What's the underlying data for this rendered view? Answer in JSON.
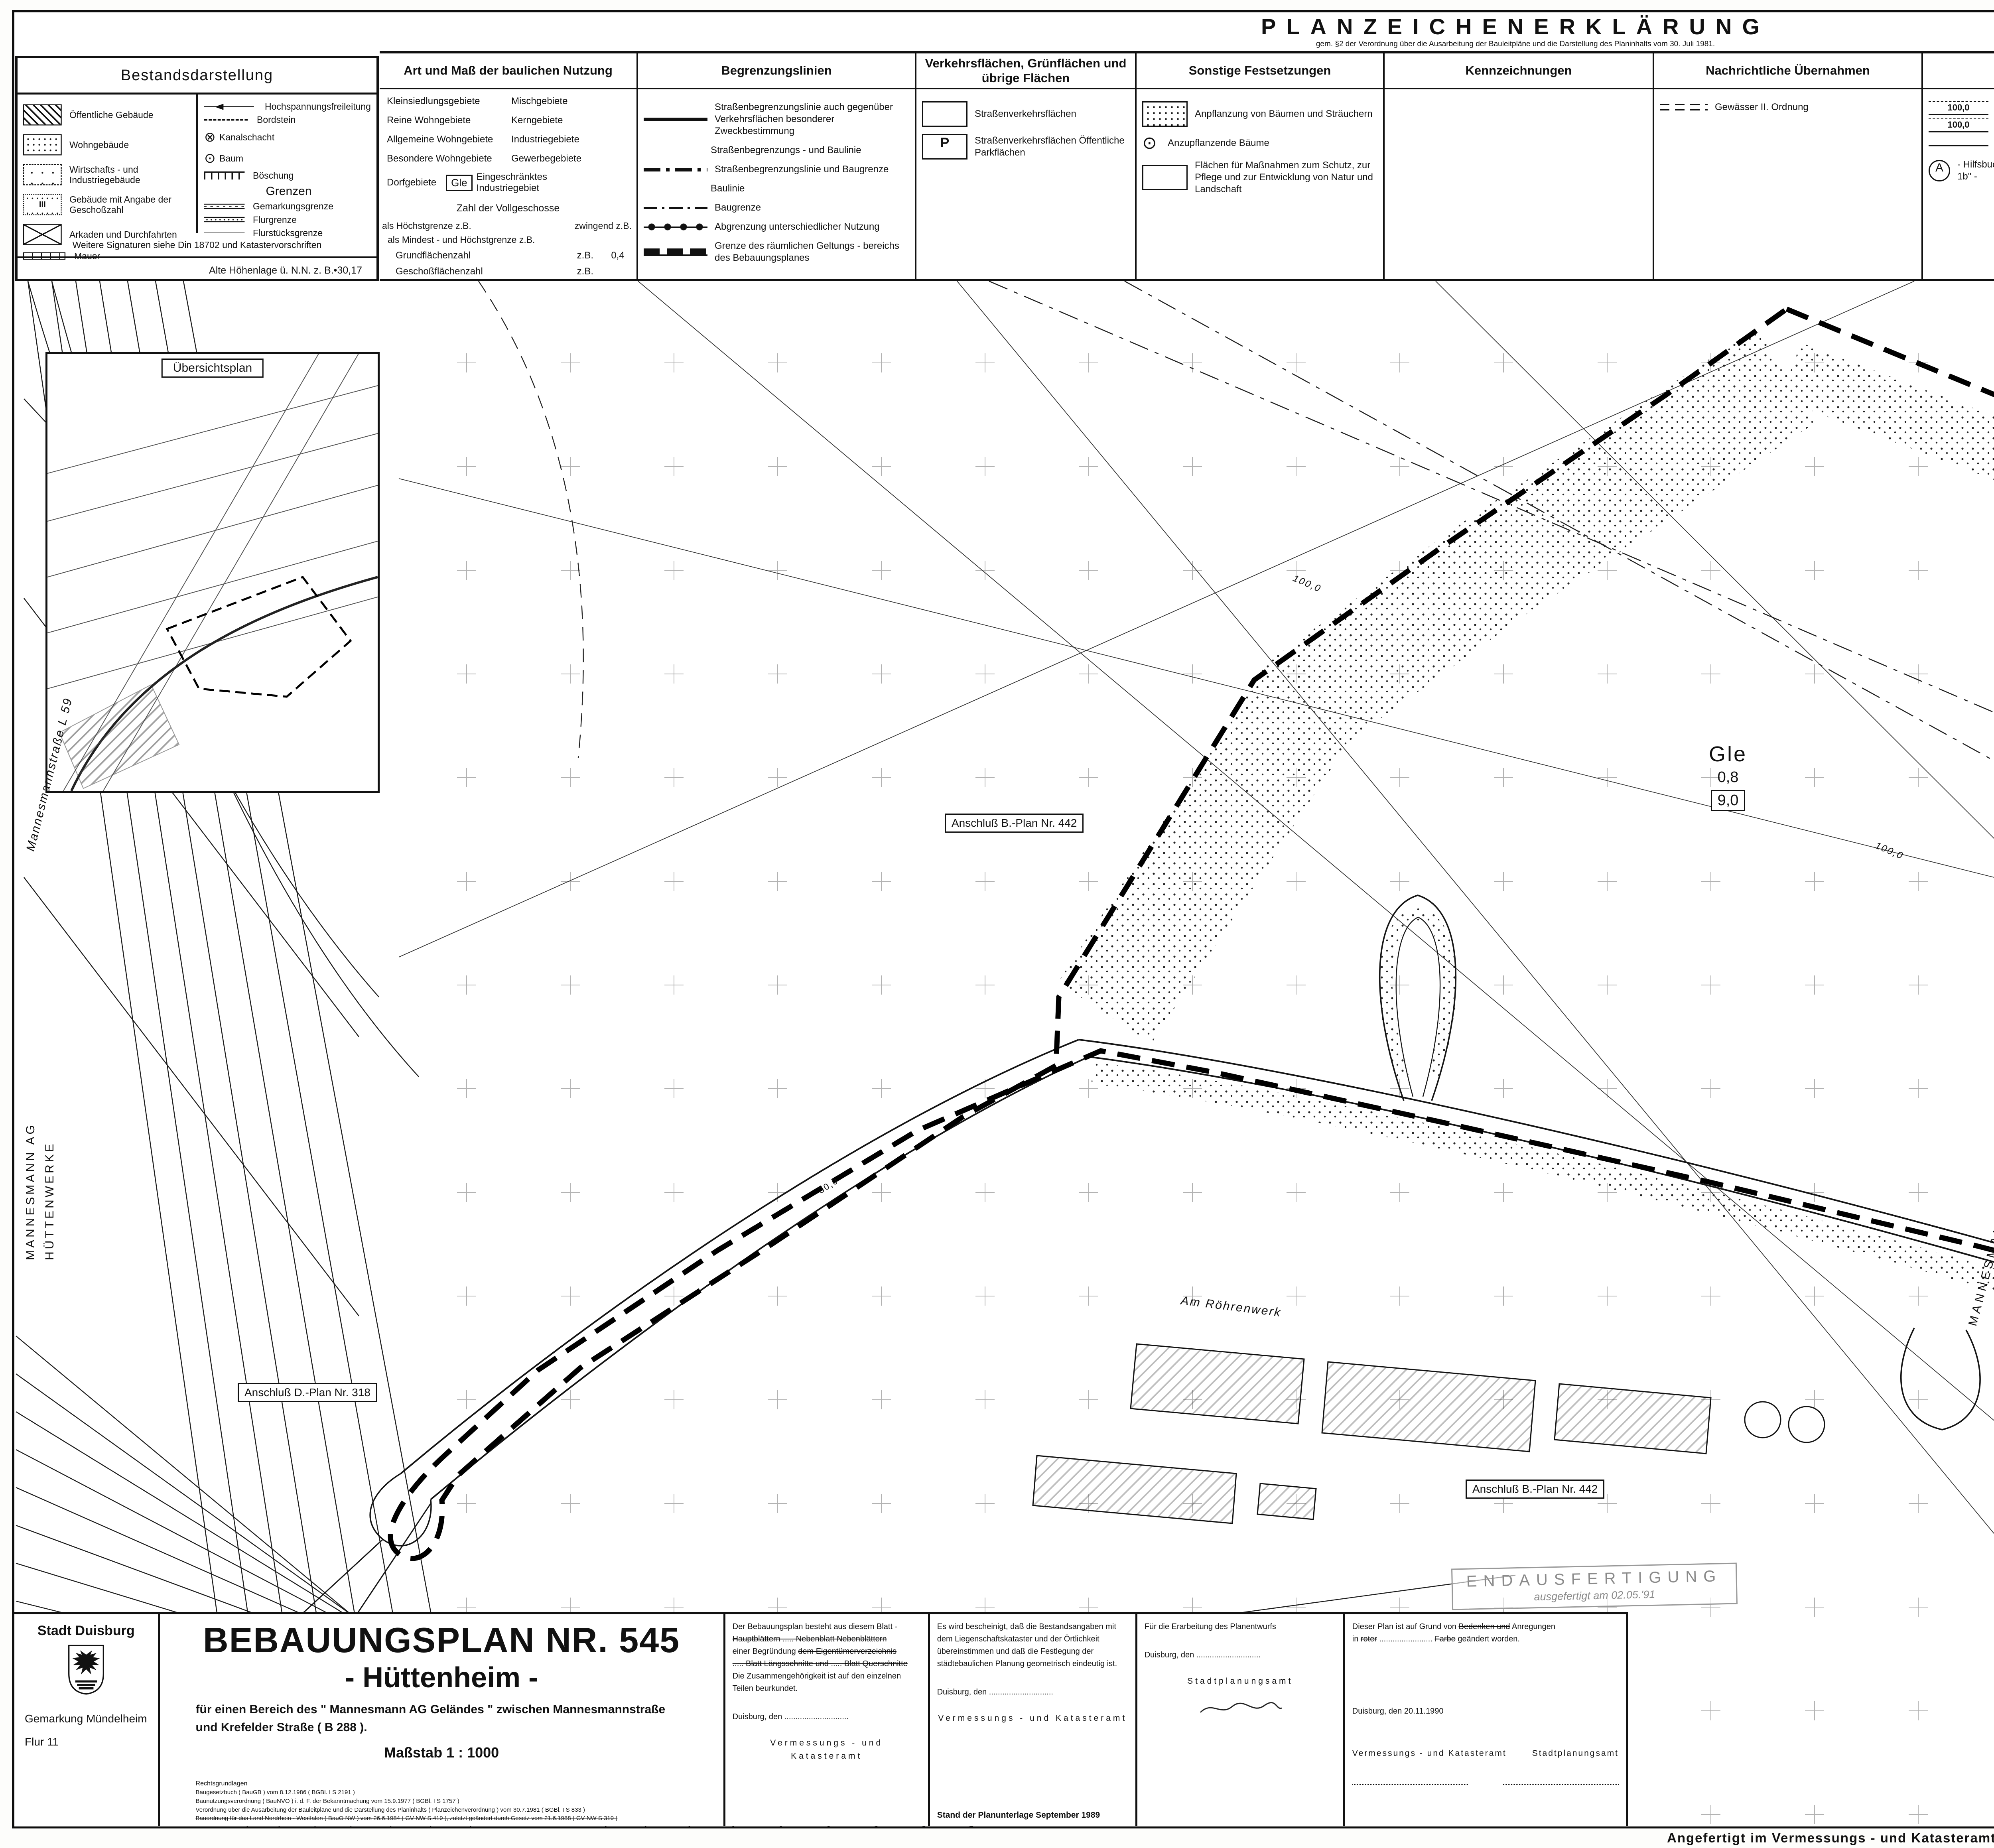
{
  "bestand": {
    "title": "Bestandsdarstellung",
    "left_items": [
      {
        "icon": "hatch-box",
        "label": "Öffentliche Gebäude"
      },
      {
        "icon": "dots-box",
        "label": "Wohngebäude"
      },
      {
        "icon": "sparse-dots-box",
        "label": "Wirtschafts - und Industriegebäude"
      },
      {
        "icon": "dots-box-iii",
        "label": "Gebäude mit Angabe der Geschoßzahl"
      },
      {
        "icon": "cross-box",
        "label": "Arkaden und Durchfahrten"
      },
      {
        "icon": "wall-symbol",
        "label": "Mauer"
      }
    ],
    "right_items": [
      {
        "icon": "arrow-line",
        "label": "Hochspannungsfreileitung"
      },
      {
        "icon": "dashed-line",
        "label": "Bordstein"
      },
      {
        "icon": "circle-cross",
        "label": "Kanalschacht"
      },
      {
        "icon": "circle-dot",
        "label": "Baum"
      },
      {
        "icon": "slope-symbol",
        "label": "Böschung"
      }
    ],
    "grenzen_title": "Grenzen",
    "grenzen_items": [
      {
        "icon": "double-line-dashdot",
        "label": "Gemarkungsgrenze"
      },
      {
        "icon": "double-line-dots",
        "label": "Flurgrenze"
      },
      {
        "icon": "single-line",
        "label": "Flurstücksgrenze"
      }
    ],
    "footer": "Weitere Signaturen siehe Din 18702 und Katastervorschriften",
    "altitude_note": "Alte Höhenlage ü. N.N. z. B.•30,17"
  },
  "plz": {
    "title": "PLANZEICHENERKLÄRUNG",
    "subtitle": "gem. §2 der Verordnung über die Ausarbeitung der Bauleitpläne und die Darstellung des Planinhalts vom 30. Juli 1981.",
    "col1": {
      "header": "Art und Maß der baulichen Nutzung",
      "pairs": [
        [
          "Kleinsiedlungsgebiete",
          "Mischgebiete"
        ],
        [
          "Reine Wohngebiete",
          "Kerngebiete"
        ],
        [
          "Allgemeine Wohngebiete",
          "Industriegebiete"
        ],
        [
          "Besondere Wohngebiete",
          "Gewerbegebiete"
        ]
      ],
      "dorf": "Dorfgebiete",
      "gle_badge": "Gle",
      "gle_label": "Eingeschränktes Industriegebiet",
      "vollgeschosse": "Zahl der Vollgeschosse",
      "hoechst": "als Höchstgrenze   z.B.",
      "zwingend": "zwingend   z.B.",
      "mindest": "als Mindest - und Höchstgrenze   z.B.",
      "grz_label": "Grundflächenzahl",
      "grz_zb": "z.B.",
      "grz_val": "0,4",
      "gfz_label": "Geschoßflächenzahl",
      "gfz_zb": "z.B.",
      "bmz_label": "Baumassenzahl",
      "bmz_zb": "z.B.",
      "bmz_val": "9,0"
    },
    "col2": {
      "header": "Begrenzungslinien",
      "items": [
        {
          "icon": "thick-line",
          "label": "Straßenbegrenzungslinie auch gegenüber Verkehrsflächen besonderer Zweckbestimmung"
        },
        {
          "icon": "none",
          "label": "Straßenbegrenzungs - und Baulinie"
        },
        {
          "icon": "dashdot-thick",
          "label": "Straßenbegrenzungslinie und Baugrenze"
        },
        {
          "icon": "none",
          "label": "Baulinie"
        },
        {
          "icon": "dashdot-thin",
          "label": "Baugrenze"
        },
        {
          "icon": "dot-knots-line",
          "label": "Abgrenzung unterschiedlicher Nutzung"
        },
        {
          "icon": "block-dash-line",
          "label": "Grenze des räumlichen Geltungs - bereichs des Bebauungsplanes"
        }
      ]
    },
    "col3": {
      "header": "Verkehrsflächen, Grünflächen und übrige Flächen",
      "items": [
        {
          "icon": "empty-box",
          "label": "Straßenverkehrsflächen"
        },
        {
          "icon": "p-box",
          "label": "Straßenverkehrsflächen Öffentliche Parkflächen"
        }
      ]
    },
    "col4": {
      "header": "Sonstige Festsetzungen",
      "items": [
        {
          "icon": "stipple-box",
          "label": "Anpflanzung von Bäumen und Sträuchern"
        },
        {
          "icon": "circle-dot",
          "label": "Anzupflanzende Bäume"
        },
        {
          "icon": "empty-box",
          "label": "Flächen für Maßnahmen zum Schutz, zur Pflege und zur Entwicklung von Natur und Landschaft"
        }
      ]
    },
    "col5": {
      "header": "Kennzeichnungen"
    },
    "col6": {
      "header": "Nachrichtliche Übernahmen",
      "items": [
        {
          "icon": "dash-double",
          "label": "Gewässer II. Ordnung"
        }
      ]
    },
    "col7": {
      "header": "Vermerke",
      "zone_value": "100,0",
      "items": [
        {
          "icon": "zone-100",
          "label": "Zone der Richtfunkverbindung - Siehe \"Textliche Festsetzungen Ziffer III.\""
        },
        {
          "icon": "thin-line",
          "label": "Neuer Bordstein"
        },
        {
          "icon": "circle-a",
          "label": "- Hilfsbuchstabe - Siehe \"Textliche Festsetzungen Ziffer I. 1b\" -"
        }
      ]
    },
    "hinweis_title": "Hinweis:",
    "hinweis_text": "Die bei Bodenbewegungen auftretenden archäologischen Bodenfunde und -befunde sind gemäß Gesetz zum Schutz und zur Pflege der Denkmäler im Land Nordrhein - Westfalen ( Denkmalschutzgesetz - DSchG ) vom 11.03.1980 unmittelbar dem Rheinischen Landesmuseum Bonn, Rheinisches Amt für Bodendenkmalpflege zu melden."
  },
  "rc": {
    "blocks": [
      {
        "body": "Der Rat der Stadt hat am 12.12.1988 nach § 2 [ 1 ] Baugesetzbuch die Aufstellung dieses Bebauungsplan - Entwurfes beschlossen.",
        "place_date": "Duisburg, den 13.10.1989",
        "officer": "Der Oberstadtdirektor",
        "deputy": "In Vertretung",
        "seal": "(Siegel)",
        "signature": "gez. Giersch",
        "rank": "Beigeordneter"
      },
      {
        "body": "Der Aufstellungsbeschluß wurde am 30.12.1988 gemäß § 2 [ 1 ] Baugesetzbuch ortsüblich bekannt gemacht.",
        "place_date": "Duisburg, den 13.10.1989",
        "officer": "Der Oberstadtdirektor",
        "deputy": "In Vertretung",
        "seal": "(Siegel)",
        "signature": "gez. Giersch",
        "rank": "Beigeordneter"
      },
      {
        "body": "Der Rat der Stadt hat am 18.09.1989 nach § 3 [1] Baugesetzbuch beschlossen, eine Bürgerbeteiligung nicht durchzuführen.",
        "place_date": "Duisburg, den 13.10.1989",
        "officer": "Der Oberstadtdirektor",
        "deputy": "In Vertretung",
        "seal": "(Siegel)",
        "signature": "gez. Giersch",
        "rank": "Beigeordneter"
      },
      {
        "body": "Ein Beschluß des Rates der Stadt nach § 3 [1] Baugesetzbuch wurde nicht gefaßt.",
        "place_date": "Duisburg, den",
        "officer": "Der Oberstadtdirektor",
        "deputy": "In Vertretung",
        "seal": "(Siegel)",
        "signature": "",
        "rank": "Beigeordneter"
      },
      {
        "body": "Der Rat der Stadt hat am 18.09.1989 nach § 3 [2] Baugesetzbuch diesen Bebauungsplan - Entwurf und seine öffentliche Auslegung beschlossen.",
        "place_date": "Duisburg, den 13.10.1989",
        "officer": "Der Oberstadtdirektor",
        "deputy": "In Vertretung",
        "seal": "(Siegel)",
        "signature": "gez. Giersch",
        "rank": "Beigeordneter"
      },
      {
        "body": "Dieser Bebauungsplan - Entwurf, die Begründung und die aufzuhebenden Bebauungspläne [ siehe Aufhebungsvermerk ] haben nach § 3 [2], § 2 [4] Baugesetzbuch auf die Dauer eines Monats in der Zeit vom 23.10.1989 bis 27.11.1989 einschließlich zu jedermanns Einsicht öffentlich ausgelegen.",
        "place_date": "Duisburg, den 21.12.1990",
        "officer": "Der Oberstadtdirektor",
        "deputy": "In Vertretung",
        "seal": "(Siegel)",
        "signature": "gez. Giersch",
        "rank": "Beigeordneter"
      },
      {
        "body": "Der Rat der Stadt hat am 17.12.1990 nach § 10 Baugesetzbuch diesen Bebauungsplan einschließlich der Änderungen in roter Farbe sowie die Aufhebungen der Festsetzungen, die diesem Bebauungsplan entgegenstehen [ siehe Aufhebungsvermerk ] als Satzung beschlossen.",
        "place_date": "Duisburg, den 21.12.1990",
        "officer": "Der Oberstadtdirektor",
        "deputy": "In Vertretung",
        "seal": "(Siegel)",
        "signature": "gez. Giersch",
        "rank": "Beigeordneter"
      },
      {
        "body": "Dieser Bebauungsplan hat mir im Anzeigeverfahren gem. § 11 Abs. 3 Baugesetzbuch vorgelegen.\nMit Verfügung vom 03.04.1991  Az.: 35.2 - 12.02 ( Dui 545 )\nhabe ich keine Rechtsverstöße geltend gemacht.",
        "place_date": "Düsseldorf, den 03.04.1991",
        "officer": "Der Regierungspräsident",
        "deputy": "Im Auftrage",
        "seal": "(Siegel)",
        "signature": "gez. Schwetlick",
        "rank": ""
      },
      {
        "body": "Die Durchführung des Anzeigeverfahrens gemäß § 11 Abs. 3 Baugesetzbuch beim Regierungspräsidenten Düsseldorf mit der Verfügung vom 03.04.1991  Az: 35.2.- 12.02 (Dui 545), daß keine Rechtsverstöße geltend gemacht wurden, ist am 02.05.1991 gemäß § 12 Baugesetzbuch mit dem Hinweis, daß dieser Bebauungsplan als Satzung mit Begründung am Tage der Veröffentlichung der Bekanntmachung ab im Zimmer 415 des Stadthauses an den Werktagen, montags bis freitags, in der Zeit von 7.30 Uhr bis 16.00 Uhr, zu jedermanns Einsicht öffentlich ausliegt, orts - üblich bekanntgemacht worden.\nMit dieser Bekanntmachung tritt der Bebauungsplan in Kraft.\nAuf die §§ 44 Abs. 3, 4 und 215 Abs. 1 Baugesetzbuch sowie auf § 4 Abs. 6 der Gemeindeordnung NW wurde bei der Bekanntmachung hingewiesen.",
        "place_date": "Duisburg, den 03.05.1991",
        "officer": "Der Oberstadtdirektor",
        "deputy": "In Vertretung",
        "seal": "(Siegel)",
        "signature": "gez. Giersch",
        "rank": "Beigeordneter"
      }
    ]
  },
  "textfest": {
    "title": "Textliche Festsetzungen",
    "paragraphs": [
      "I. Art und Maß der Nutzung auf den überbaubaren und nicht überbaubaren Grund-\n   stücksflächen",
      "  1. Gemäß § 1 Abs. 9 in Verbindung mit § 1 Abs. 5 der Baunutzungsverordnung\n     (BauNVO) sind",
      "     a) im gesamten GIe-Gebiet die in der \"Abstandsliste\" zum Abstandserlaß\n        (RdErl. d. Ministers für Arbeit, Gesundheit und Soziales - III 86 -\n        8804.25 - vom 09.07.1982) aufgeführten Betriebsarten der Abstands-\n        klassen I, II, III und IV sowie Anlagen mit ähnlichem Emissionsgrad\n        nicht zulässig und",
      "     b) zusätzlich in dem mit Ⓐ bezeichneten südöstlichen Bereich die in der\n        genannten \"Abstandsliste\" aufgeführten Betriebsarten der Abstands-\n        klasse V sowie Anlagen mit ähnlichem Emissionsgrad nicht zulässig.",
      "II. Festsetzungen gemäß § 9 (1) 25 a  Baugesetzbuch (BauGB)",
      "  1. In den durch die Geländeanschüttung entstehenden Böschungsbereichen sind\n     folgende heimische Laubgehölze anzupflanzen:",
      "     Spitzahorn, Bergahorn, Stieleiche, Winterlinde, Kornelkirsche, Hart-\n     riegel, Hasel, Eingriffeliger Weißdorn, Pfaffenhütchen, Sanddorn,\n     Kreuzdorn, Wolliger Schneeball, Feldahorn, Hainbuche, Vogelbeere, Ge-\n     meine Heckenkirsche, Vielblütige Wildrose, Brombeere.",
      "  2. Die im Bebauungsplan festgesetzten Flächen für Anpflanzung von Bäumen\n     und Sträuchern sind mit den unter 1. aufgeführten Pflanzen zu begrünen.",
      "  3. Ebenerdige Stellplatzflächen sind derart zu begrünen, daß für jeweils 5\n     Stellplätze ein großkroniger Laubbaum gepflanzt wird.",
      "  4. Fassadenflächen, die auf einer Länge von 4 m keine Fenster, Tor- oder\n     Türöffnungen enthalten, sind pro angefangener 4 m mit einer der folgenden\n     Kletterpflanzen zu begrünen:",
      "     Waldrebe, Efeu, Wilder Wein, Knöterich,  Je-länger - je lieber.",
      "III. Fesetzungen gemäß § 9 (2) BauGB",
      "     Innerhalb der im Plan gekennzeichneten 200 m breiten Zone - Richtfunk-\n     strecke der Deutschen Bundespost - darf die Gebäudehöhe (einschließ-\n     lich Aufbauten, Antennen usw.) 100 m über NN nicht überschreiten."
    ]
  },
  "aufhebung": {
    "title": "Aufhebungsvermerk",
    "paragraphs": [
      "Mit Inkrafttreten dieses Bebauungsplanes sind alle nach früheren baurecht-\nlichen Vorschriften und städtebaulichen Plänen im Bereich dieses Bebauungs-\nplanes getroffenen Festsetzungen aufgehoben.",
      "Hierbei handelt es sich um die",
      "a) teilweise Aufhebung des Bebauungsplanes Nr. 442, Gebiet zwischen Mannes-\n   mannstraße, Ungelsheimer Graben, Krefelder Straße und Goldackergraben,\n   rechtsverbindlich seit dem 10.11.1964",
      "   und die",
      "b) teilweise Aufhebung des Durchführungsplanes Nr. 318, Blatt 3 und 5, Ver-\n   legung der Huckinger Straße (jetzt Mannesmannstraße) zwischen Hüttenheim\n   und Ehinger Berg, förmlich festgestellt am 20.04.1959."
    ],
    "oertliche": "Örtliche Bauvorschriften entfallen!"
  },
  "map": {
    "uebersichtsplan": "Übersichtsplan",
    "gle": "Gle",
    "gle_value": "0,8",
    "gle_box": "9,0",
    "hilfsbuchstabe": "A",
    "natur_box": "Fläche für Maßnahmen\nzum Schutz, zur Pflege\nund zur Entwicklung\nvon Natur und Land-\nschaft\n-Naturbelassene Fläche-",
    "anschluss_442": "Anschluß B.-Plan Nr. 442",
    "anschluss_318": "Anschluß D.-Plan Nr. 318",
    "street_am_roehrenwerk": "Am Röhrenwerk",
    "mannesmann_ag": "MANNESMANN AG",
    "huettenwerke": "HÜTTENWERKE",
    "mannesmannstrasse": "Mannesmannstraße  L 59",
    "krefelder": "Krefelder Straße  B 288",
    "zone_width": "100,0",
    "dim1": "6,5",
    "dim2": "69,0",
    "dim3": "3,0",
    "dim4": "30,0"
  },
  "bottom": {
    "stadt": {
      "name": "Stadt  Duisburg",
      "gemarkung": "Gemark ung Mündelheim",
      "gemarkung_fix": "Gemarkung Mündelheim",
      "flur": "Flur 11"
    },
    "title": {
      "main": "BEBAUUNGSPLAN NR. 545",
      "sub": "- Hüttenheim -",
      "desc": "für einen Bereich des \" Mannesmann AG Geländes \" zwischen Mannesmannstraße\nund Krefelder Straße ( B 288 ).",
      "scale": "Maßstab  1 : 1000",
      "legal_title": "Rechtsgrundlagen",
      "legal_lines": [
        "Baugesetzbuch ( BauGB ) vom 8.12.1986 ( BGBl. I S 2191 )",
        "Baunutzungsverordnung ( BauNVO ) i. d. F. der Bekanntmachung vom 15.9.1977 ( BGBl. I S 1757 )",
        "Verordnung über die Ausarbeitung der Bauleitpläne und die Darstellung des Planinhalts ( Planzeichenverordnung ) vom 30.7.1981 ( BGBl. I S 833 )",
        "Bauordnung für das Land Nordrhein - Westfalen ( BauO NW ) vom 26.6.1984 ( GV NW S.419 ), zuletzt geändert durch Gesetz vom 21.6.1988 ( GV NW S 319 )"
      ]
    },
    "box1": {
      "l1": "Der Bebauungsplan besteht aus  diesem Blatt -",
      "l2": "Hauptblättern ..... Nebenblatt  Nebenblättern",
      "l3a": "einer Begründung ",
      "l3b": "dem Eigentümerverzeichnis",
      "l4": "..... Blatt Längsschnitte und ..... Blatt Querschnitte",
      "l5": "Die Zusammengehörigkeit ist auf den einzelnen Teilen beurkundet.",
      "place": "Duisburg, den .............................",
      "office": "Vermessungs - und Katasteramt"
    },
    "box2": {
      "text": "Es wird bescheinigt, daß die Bestandsangaben mit dem Liegenschaftskataster und der Örtlichkeit übereinstimmen und daß die Festlegung der städtebaulichen Planung geometrisch eindeutig ist.",
      "place": "Duisburg, den .............................",
      "office": "Vermessungs - und Katasteramt",
      "note": "Stand der Planunterlage September 1989"
    },
    "box3": {
      "text": "Für die Erarbeitung des Planentwurfs",
      "place": "Duisburg, den .............................",
      "office": "Stadtplanungsamt"
    },
    "box4": {
      "l1a": "Dieser Plan ist auf Grund von ",
      "l1b": "Bedenken und",
      "l1c": " Anregungen",
      "l2a": "in ",
      "l2b": "roter",
      "l2c": " ........................ ",
      "l2d": "Farbe",
      "l2e": " geändert worden.",
      "place": "Duisburg, den  20.11.1990",
      "office1": "Vermessungs - und Katasteramt",
      "office2": "Stadtplanungsamt"
    },
    "satzung": {
      "body": "Diese Satzung entspricht dem\nBeschluß des Rates der Stadt\nvom 17.12.1990.",
      "place": "Duisburg, den 19.04.1991",
      "signature": "gez. Krings",
      "rank": "Oberbürgermeister"
    },
    "stamp": {
      "line1": "ENDAUSFERTIGUNG",
      "line2": "ausgefertigt am  02.05.'91"
    },
    "angefertigt": "Angefertigt im Vermessungs - und Katasteramt  1989"
  }
}
